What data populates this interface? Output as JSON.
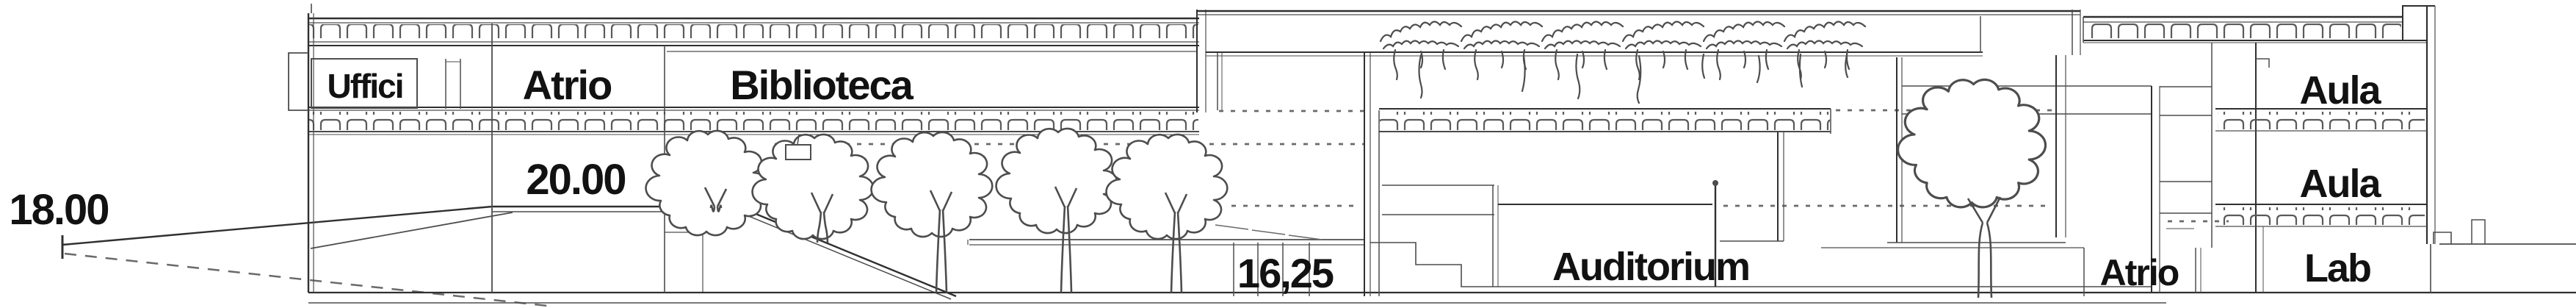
{
  "drawing": {
    "kind": "architectural longitudinal building section",
    "rooms": {
      "uffici": "Uffici",
      "atrio_left": "Atrio",
      "biblioteca": "Biblioteca",
      "auditorium": "Auditorium",
      "atrio_right": "Atrio",
      "aula_upper": "Aula",
      "aula_lower": "Aula",
      "lab": "Lab"
    },
    "elevations": {
      "site_left": "18.00",
      "plaza": "20.00",
      "auditorium_level": "16,25"
    }
  },
  "colors": {
    "ink": "#4d4d4d",
    "ink_strong": "#303030",
    "ink_light": "#6a6a6a",
    "text": "#121212",
    "paper": "#ffffff"
  }
}
